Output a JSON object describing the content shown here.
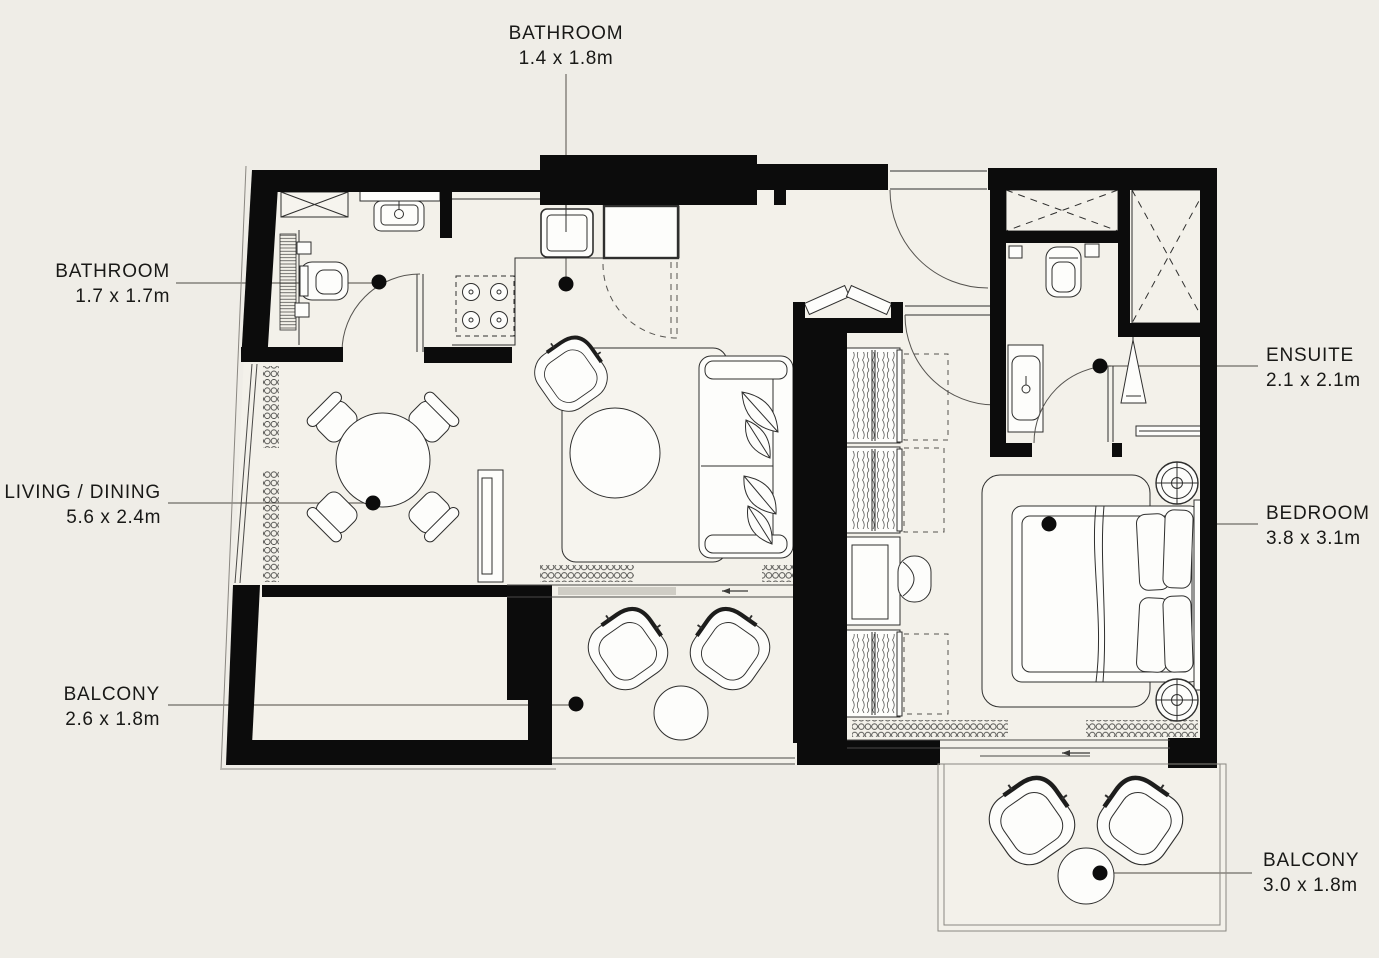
{
  "colors": {
    "background": "#efede7",
    "floor": "#f3f1ea",
    "wall": "#0c0c0c",
    "furniture_line": "#2f2f2e",
    "leader_line": "#6e6b65",
    "marker_dot": "#0c0c0c",
    "sliding_door_gray": "#cfcdc5"
  },
  "labels": {
    "bathroom_top": {
      "name": "BATHROOM",
      "dims": "1.4 x 1.8m"
    },
    "bathroom_left": {
      "name": "BATHROOM",
      "dims": "1.7 x 1.7m"
    },
    "living_dining": {
      "name": "LIVING / DINING",
      "dims": "5.6 x 2.4m"
    },
    "balcony_left": {
      "name": "BALCONY",
      "dims": "2.6 x 1.8m"
    },
    "ensuite": {
      "name": "ENSUITE",
      "dims": "2.1 x 2.1m"
    },
    "bedroom": {
      "name": "BEDROOM",
      "dims": "3.8 x 3.1m"
    },
    "balcony_right": {
      "name": "BALCONY",
      "dims": "3.0 x 1.8m"
    }
  }
}
